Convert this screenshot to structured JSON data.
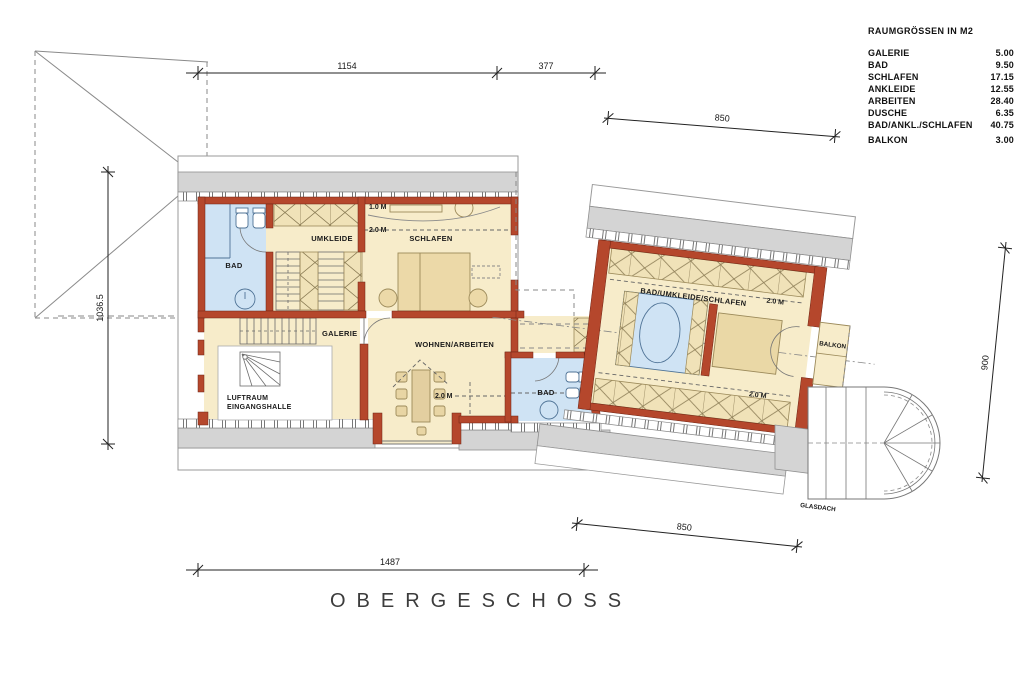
{
  "legend": {
    "title": "RAUMGRÖSSEN IN M2",
    "rows": [
      {
        "name": "GALERIE",
        "value": "5.00"
      },
      {
        "name": "BAD",
        "value": "9.50"
      },
      {
        "name": "SCHLAFEN",
        "value": "17.15"
      },
      {
        "name": "ANKLEIDE",
        "value": "12.55"
      },
      {
        "name": "ARBEITEN",
        "value": "28.40"
      },
      {
        "name": "DUSCHE",
        "value": "6.35"
      },
      {
        "name": "BAD/ANKL./SCHLAFEN",
        "value": "40.75"
      },
      {
        "name": "BALKON",
        "value": "3.00"
      }
    ]
  },
  "caption": "OBERGESCHOSS",
  "dimensions": {
    "top_left": "1154",
    "top_mid": "377",
    "top_right": "850",
    "left": "1036.5",
    "right": "900",
    "bottom_right": "850",
    "bottom": "1487"
  },
  "rooms": {
    "bad1": "BAD",
    "umkleide": "UMKLEIDE",
    "schlafen": "SCHLAFEN",
    "galerie": "GALERIE",
    "wohnen": "WOHNEN/ARBEITEN",
    "luftraum_line1": "LUFTRAUM",
    "luftraum_line2": "EINGANGSHALLE",
    "bad2": "BAD",
    "suite": "BAD/UMKLEIDE/SCHLAFEN",
    "balkon": "BALKON",
    "glasdach": "GLASDACH"
  },
  "marks": {
    "m10": "1.0 M",
    "m20": "2.0 M"
  },
  "colors": {
    "wall_red": "#b5472c",
    "floor_beige": "#f7ecca",
    "closet_beige": "#f0e2b8",
    "bath_blue": "#cfe3f4",
    "roof_gray": "#d4d4d4"
  }
}
